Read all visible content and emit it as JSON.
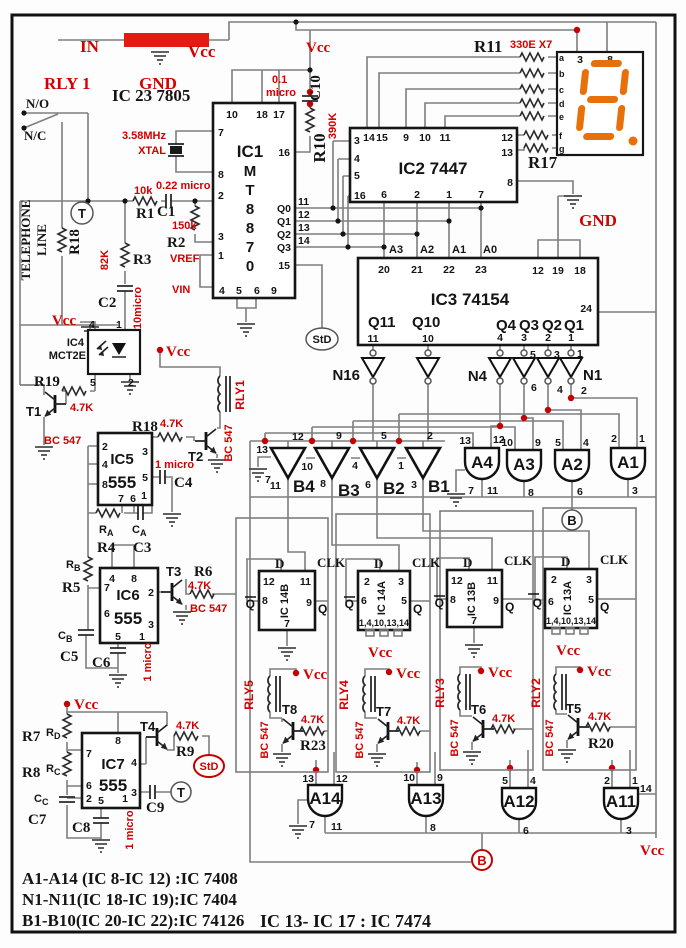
{
  "t": {
    "in": "IN",
    "gnd": "GND",
    "vcc": "Vcc",
    "ic23": "IC 23 7805",
    "rly1cap": "RLY 1",
    "no": "N/O",
    "nc": "N/C",
    "tel1": "TELEPHONE",
    "tel2": "LINE",
    "tcirc": "T",
    "std": "StD",
    "r18": "R18",
    "r1": "R1",
    "r2": "R2",
    "r3": "R3",
    "r4": "R4",
    "r5": "R5",
    "r6": "R6",
    "r7": "R7",
    "r8": "R8",
    "r9": "R9",
    "r10": "R10",
    "r11": "R11",
    "r17": "R17",
    "r19": "R19",
    "r20": "R20",
    "r23": "R23",
    "c1": "C1",
    "c2": "C2",
    "c3": "C3",
    "c4": "C4",
    "c5": "C5",
    "c6": "C6",
    "c7": "C7",
    "c8": "C8",
    "c9": "C9",
    "c10": "C10",
    "v10k": "10k",
    "v022": "0.22 micro",
    "v150k": "150k",
    "v82k": "82K",
    "v10m": "10micro",
    "v01": "0.1",
    "vmic": "micro",
    "v390": "390K",
    "v330": "330E X7",
    "v47": "4.7K",
    "v1m": "1 micro",
    "bc": "BC 547",
    "x1": "3.58MHz",
    "x2": "XTAL",
    "vref": "VREF",
    "vin": "VIN",
    "ic1": "IC1",
    "chM": "M",
    "chT": "T",
    "ch8": "8",
    "ch7": "7",
    "ch0": "0",
    "q0": "Q0",
    "q1": "Q1",
    "q2": "Q2",
    "q3": "Q3",
    "q4": "Q4",
    "q10": "Q10",
    "q11": "Q11",
    "ic2": "IC2 7447",
    "ic3": "IC3 74154",
    "ic4": "IC4",
    "mct": "MCT2E",
    "ic5": "IC5",
    "ic6": "IC6",
    "ic7": "IC7",
    "v555": "555",
    "ic14b": "IC 14B",
    "ic14a": "IC 14A",
    "ic13b": "IC 13B",
    "ic13a": "IC 13A",
    "ffp": "1,4,10,13,14",
    "dlab": "D",
    "clk": "CLK",
    "qlab": "Q",
    "a0": "A0",
    "a1": "A1",
    "a2": "A2",
    "a3": "A3",
    "a4": "A4",
    "a11": "A11",
    "a12": "A12",
    "a13": "A13",
    "a14": "A14",
    "b1": "B1",
    "b2": "B2",
    "b3": "B3",
    "b4": "B4",
    "n1": "N1",
    "n4": "N4",
    "n16": "N16",
    "rly1": "RLY1",
    "rly2": "RLY2",
    "rly3": "RLY3",
    "rly4": "RLY4",
    "rly5": "RLY5",
    "t1": "T1",
    "t2": "T2",
    "t3": "T3",
    "t4": "T4",
    "t5": "T5",
    "t6": "T6",
    "t7": "T7",
    "t8": "T8",
    "sR": "R",
    "sC": "C",
    "sA": "A",
    "sB": "B",
    "sD": "D",
    "bcir": "B",
    "sega": "a",
    "segb": "b",
    "segc": "c",
    "segd": "d",
    "sege": "e",
    "segf": "f",
    "segg": "g"
  },
  "n": {
    "1": "1",
    "2": "2",
    "3": "3",
    "4": "4",
    "5": "5",
    "6": "6",
    "7": "7",
    "8": "8",
    "9": "9",
    "10": "10",
    "11": "11",
    "12": "12",
    "13": "13",
    "14": "14",
    "15": "15",
    "16": "16",
    "17": "17",
    "18": "18",
    "19": "19",
    "20": "20",
    "21": "21",
    "22": "22",
    "23": "23",
    "24": "24"
  },
  "legend": {
    "l1": "A1-A14 (IC 8-IC 12) :IC 7408",
    "l2": "N1-N11(IC 18-IC 19):IC 7404",
    "l3": "B1-B10(IC 20-IC 22):IC 74126",
    "l4": "IC 13- IC 17 : IC 7474"
  },
  "colors": {
    "red": "#d40000",
    "segment": "#e8700a",
    "wire": "#7e7e7e",
    "regulator": "#e41b13"
  }
}
